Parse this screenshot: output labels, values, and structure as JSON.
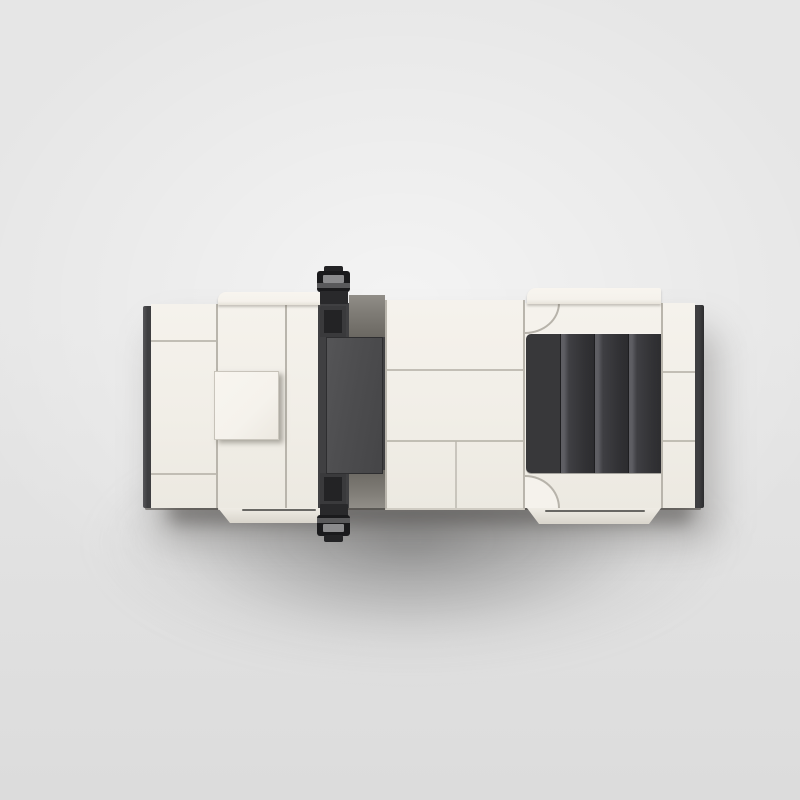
{
  "scene": {
    "subject": "Top-down studio render of a white LEGO brick model car on a gray background",
    "view": "top view",
    "parts": {
      "car": "white brick-built model car, top view",
      "front_bumper": "front bumper dark trim",
      "hood_left": "hood panel (front)",
      "hood_center": "hood panel (center)",
      "hood_scoop": "raised hood scoop block",
      "cowl": "cowl panel",
      "windshield": "tinted windshield and cabin front",
      "windshield_glass": "dark tinted glass slab",
      "mirror_top": "side mirror (upper side)",
      "mirror_bottom": "side mirror (lower side)",
      "roof": "roof panels",
      "rear_deck": "rear deck panels",
      "louvers": "black rear engine louvers (4 slats)",
      "rear_quarter": "rear quarter panel",
      "rear_bumper": "rear bumper dark trim",
      "fender_front_top": "front wheel fender (upper)",
      "fender_front_bottom": "front wheel fender (lower)",
      "fender_rear_top": "rear wheel fender (upper)",
      "fender_rear_bottom": "rear wheel fender (lower)",
      "shadow": "soft drop shadow"
    }
  },
  "colors": {
    "bg-top": "#e6e6e6",
    "bg-bottom": "#dcdcdc",
    "ivory": "#f1eee7",
    "ivory-bright": "#f5f2ec",
    "ivory-dim": "#ece9e1",
    "ivory-shade": "#cfcbc2",
    "seam": "#b9b5ac",
    "dark-trim": "#3e3e40",
    "glass": "#4d4d4f",
    "glass-frame": "#404042",
    "corner-black": "#232325",
    "cowl-gray": "#7e7b75",
    "louver-flat": "#38383a",
    "louver-fin": "#3f3f43",
    "louver-edge": "#5e5e63",
    "louver-sep": "#1e1e20",
    "mirror-black": "#1a1a1c",
    "mirror-gray": "#8b8b8d"
  }
}
